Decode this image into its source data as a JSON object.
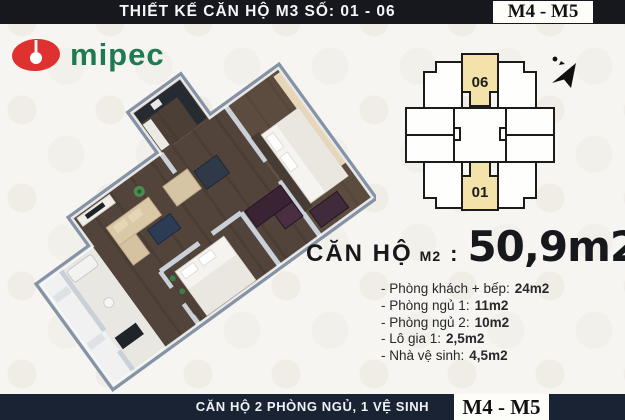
{
  "header": {
    "title": "THIẾT KẾ CĂN HỘ M3 SỐ: 01 - 06",
    "badge": "M4 - M5"
  },
  "logo": {
    "text": "mipec"
  },
  "site_plan": {
    "unit_top": "06",
    "unit_bottom": "01"
  },
  "area_line": {
    "prefix": "CĂN HỘ",
    "unit_code": "M2",
    "separator": ":",
    "area": "50,9m2"
  },
  "room_list": [
    {
      "label": "- Phòng khách + bếp:",
      "value": "24m2"
    },
    {
      "label": "- Phòng ngủ 1:",
      "value": "11m2"
    },
    {
      "label": "- Phòng ngủ 2:",
      "value": "10m2"
    },
    {
      "label": "- Lô gia 1:",
      "value": "2,5m2"
    },
    {
      "label": "- Nhà vệ sinh:",
      "value": "4,5m2"
    }
  ],
  "footer": {
    "title": "CĂN HỘ 2 PHÒNG NGỦ, 1 VỆ SINH",
    "badge": "M4 - M5"
  },
  "colors": {
    "unit_highlight": "#f3e2a9",
    "brand_red": "#e03131",
    "brand_green": "#1e7b4f",
    "top_bar": "#16181d",
    "bottom_bar": "#1a2334",
    "wall_gray": "#8593a5"
  }
}
